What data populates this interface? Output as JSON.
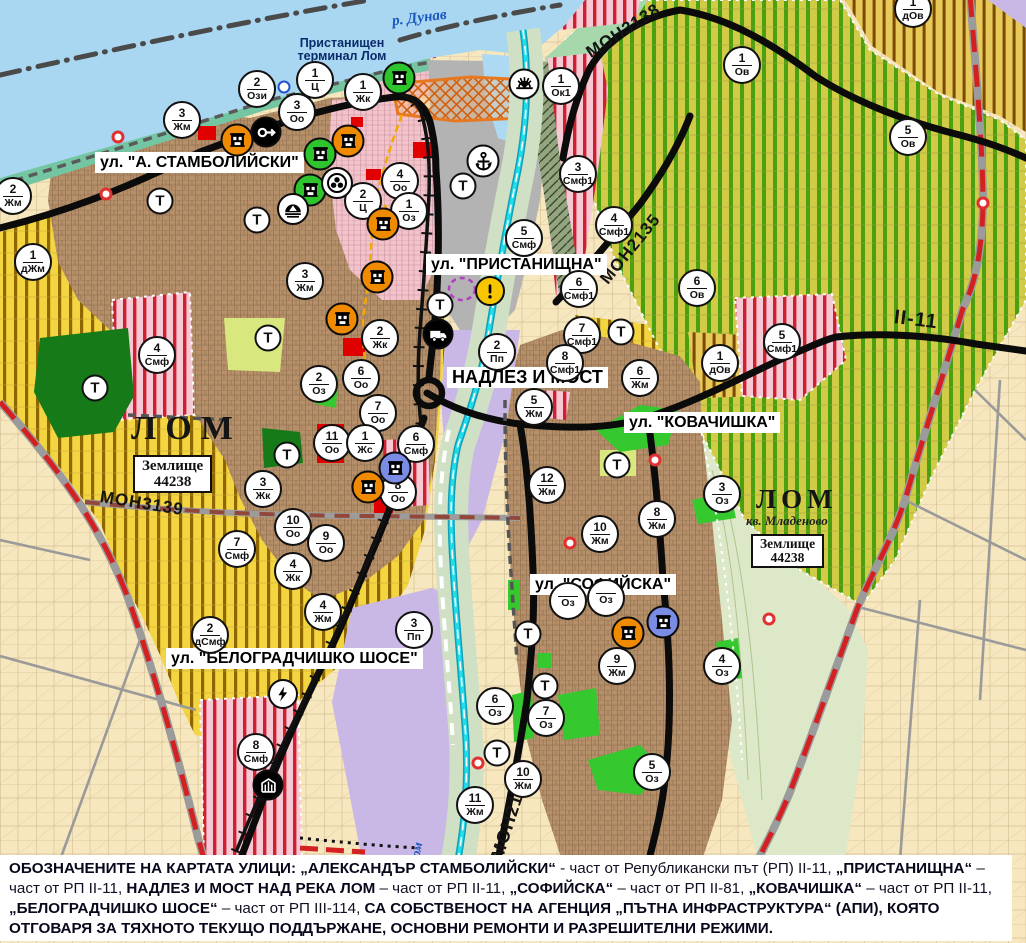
{
  "map": {
    "place_labels": {
      "danube": "р. Дунав",
      "terminal_line1": "Пристанищен",
      "terminal_line2": "терминал Лом",
      "lom_city": "ЛОМ",
      "zemlishte1_line1": "Землище",
      "zemlishte1_line2": "44238",
      "lom_mladenovo": "ЛОМ",
      "kv_mladenovo": "кв. Младеново",
      "zemlishte2_line1": "Землище",
      "zemlishte2_line2": "44238"
    },
    "road_labels": {
      "mon3139": "МОН3139",
      "mon3138": "МОН3138",
      "mon2135": "МОН2135",
      "mon2136": "МОН2136",
      "ii11": "II-11",
      "lom_river": "Лом"
    },
    "street_labels": [
      {
        "id": "stamb",
        "text": "ул. \"А. СТАМБОЛИЙСКИ\"",
        "x": 95,
        "y": 152
      },
      {
        "id": "prist",
        "text": "ул. \"ПРИСТАНИЩНА\"",
        "x": 426,
        "y": 254
      },
      {
        "id": "nadlez",
        "text": "НАДЛЕЗ И МОСТ",
        "x": 447,
        "y": 367,
        "big": true
      },
      {
        "id": "kovach",
        "text": "ул. \"КОВАЧИШКА\"",
        "x": 624,
        "y": 412
      },
      {
        "id": "sofia",
        "text": "ул. \"СОФИЙСКА\"",
        "x": 530,
        "y": 574
      },
      {
        "id": "belograd",
        "text": "ул. \"БЕЛОГРАДЧИШКО ШОСЕ\"",
        "x": 166,
        "y": 648
      }
    ],
    "zone_markers": [
      {
        "x": 257,
        "y": 89,
        "num": "2",
        "code": "Ози"
      },
      {
        "x": 315,
        "y": 80,
        "num": "1",
        "code": "Ц"
      },
      {
        "x": 363,
        "y": 92,
        "num": "1",
        "code": "Жк"
      },
      {
        "x": 297,
        "y": 112,
        "num": "3",
        "code": "Оо"
      },
      {
        "x": 182,
        "y": 120,
        "num": "3",
        "code": "Жм"
      },
      {
        "x": 13,
        "y": 196,
        "num": "2",
        "code": "Жм"
      },
      {
        "x": 33,
        "y": 262,
        "num": "1",
        "code": "дЖм"
      },
      {
        "x": 400,
        "y": 181,
        "num": "4",
        "code": "Оо"
      },
      {
        "x": 363,
        "y": 201,
        "num": "2",
        "code": "Ц"
      },
      {
        "x": 409,
        "y": 211,
        "num": "1",
        "code": "Оз"
      },
      {
        "x": 305,
        "y": 281,
        "num": "3",
        "code": "Жм"
      },
      {
        "x": 561,
        "y": 86,
        "num": "1",
        "code": "Ок1"
      },
      {
        "x": 742,
        "y": 65,
        "num": "1",
        "code": "Ов"
      },
      {
        "x": 908,
        "y": 137,
        "num": "5",
        "code": "Ов"
      },
      {
        "x": 913,
        "y": 9,
        "num": "1",
        "code": "дОв"
      },
      {
        "x": 578,
        "y": 174,
        "num": "3",
        "code": "Смф1"
      },
      {
        "x": 614,
        "y": 225,
        "num": "4",
        "code": "Смф1"
      },
      {
        "x": 524,
        "y": 238,
        "num": "5",
        "code": "Смф"
      },
      {
        "x": 579,
        "y": 289,
        "num": "6",
        "code": "Смф1"
      },
      {
        "x": 582,
        "y": 335,
        "num": "7",
        "code": "Смф1"
      },
      {
        "x": 565,
        "y": 363,
        "num": "8",
        "code": "Смф1"
      },
      {
        "x": 697,
        "y": 288,
        "num": "6",
        "code": "Ов"
      },
      {
        "x": 720,
        "y": 363,
        "num": "1",
        "code": "дОв"
      },
      {
        "x": 782,
        "y": 342,
        "num": "5",
        "code": "Смф1"
      },
      {
        "x": 497,
        "y": 352,
        "num": "2",
        "code": "Пп"
      },
      {
        "x": 157,
        "y": 355,
        "num": "4",
        "code": "Смф"
      },
      {
        "x": 319,
        "y": 384,
        "num": "2",
        "code": "Оз"
      },
      {
        "x": 361,
        "y": 378,
        "num": "6",
        "code": "Оо"
      },
      {
        "x": 380,
        "y": 338,
        "num": "2",
        "code": "Жк"
      },
      {
        "x": 378,
        "y": 413,
        "num": "7",
        "code": "Оо"
      },
      {
        "x": 332,
        "y": 443,
        "num": "11",
        "code": "Оо"
      },
      {
        "x": 365,
        "y": 443,
        "num": "1",
        "code": "Жс"
      },
      {
        "x": 416,
        "y": 444,
        "num": "6",
        "code": "Смф"
      },
      {
        "x": 398,
        "y": 492,
        "num": "8",
        "code": "Оо"
      },
      {
        "x": 263,
        "y": 489,
        "num": "3",
        "code": "Жк"
      },
      {
        "x": 293,
        "y": 527,
        "num": "10",
        "code": "Оо"
      },
      {
        "x": 326,
        "y": 543,
        "num": "9",
        "code": "Оо"
      },
      {
        "x": 293,
        "y": 571,
        "num": "4",
        "code": "Жк"
      },
      {
        "x": 237,
        "y": 549,
        "num": "7",
        "code": "Смф"
      },
      {
        "x": 534,
        "y": 407,
        "num": "5",
        "code": "Жм"
      },
      {
        "x": 640,
        "y": 378,
        "num": "6",
        "code": "Жм"
      },
      {
        "x": 547,
        "y": 485,
        "num": "12",
        "code": "Жм"
      },
      {
        "x": 600,
        "y": 534,
        "num": "10",
        "code": "Жм"
      },
      {
        "x": 657,
        "y": 519,
        "num": "8",
        "code": "Жм"
      },
      {
        "x": 722,
        "y": 494,
        "num": "3",
        "code": "Оз"
      },
      {
        "x": 568,
        "y": 601,
        "num": "",
        "code": "Оз"
      },
      {
        "x": 606,
        "y": 598,
        "num": "",
        "code": "Оз"
      },
      {
        "x": 617,
        "y": 666,
        "num": "9",
        "code": "Жм"
      },
      {
        "x": 722,
        "y": 666,
        "num": "4",
        "code": "Оз"
      },
      {
        "x": 546,
        "y": 718,
        "num": "7",
        "code": "Оз"
      },
      {
        "x": 495,
        "y": 706,
        "num": "6",
        "code": "Оз"
      },
      {
        "x": 652,
        "y": 772,
        "num": "5",
        "code": "Оз"
      },
      {
        "x": 523,
        "y": 779,
        "num": "10",
        "code": "Жм"
      },
      {
        "x": 475,
        "y": 805,
        "num": "11",
        "code": "Жм"
      },
      {
        "x": 210,
        "y": 635,
        "num": "2",
        "code": "дСмф"
      },
      {
        "x": 323,
        "y": 612,
        "num": "4",
        "code": "Жм"
      },
      {
        "x": 414,
        "y": 630,
        "num": "3",
        "code": "Пп"
      },
      {
        "x": 256,
        "y": 752,
        "num": "8",
        "code": "Смф"
      }
    ],
    "t_markers": [
      {
        "x": 160,
        "y": 201
      },
      {
        "x": 257,
        "y": 220
      },
      {
        "x": 463,
        "y": 186
      },
      {
        "x": 440,
        "y": 305
      },
      {
        "x": 268,
        "y": 338
      },
      {
        "x": 95,
        "y": 388
      },
      {
        "x": 287,
        "y": 455
      },
      {
        "x": 621,
        "y": 332
      },
      {
        "x": 617,
        "y": 465
      },
      {
        "x": 528,
        "y": 634
      },
      {
        "x": 545,
        "y": 686
      },
      {
        "x": 497,
        "y": 753
      }
    ],
    "icon_markers": [
      {
        "x": 237,
        "y": 140,
        "type": "monument",
        "color": "orange"
      },
      {
        "x": 348,
        "y": 141,
        "type": "monument",
        "color": "orange"
      },
      {
        "x": 383,
        "y": 224,
        "type": "monument",
        "color": "orange"
      },
      {
        "x": 377,
        "y": 277,
        "type": "monument",
        "color": "orange"
      },
      {
        "x": 342,
        "y": 319,
        "type": "monument",
        "color": "orange"
      },
      {
        "x": 368,
        "y": 487,
        "type": "monument",
        "color": "orange"
      },
      {
        "x": 628,
        "y": 633,
        "type": "monument",
        "color": "orange"
      },
      {
        "x": 399,
        "y": 78,
        "type": "monument",
        "color": "green"
      },
      {
        "x": 320,
        "y": 154,
        "type": "monument",
        "color": "green"
      },
      {
        "x": 310,
        "y": 190,
        "type": "monument",
        "color": "green"
      },
      {
        "x": 395,
        "y": 468,
        "type": "monument",
        "color": "blue"
      },
      {
        "x": 663,
        "y": 622,
        "type": "monument",
        "color": "blue"
      },
      {
        "x": 266,
        "y": 132,
        "type": "key"
      },
      {
        "x": 337,
        "y": 183,
        "type": "rotunda"
      },
      {
        "x": 293,
        "y": 209,
        "type": "tunnel"
      },
      {
        "x": 483,
        "y": 161,
        "type": "anchor"
      },
      {
        "x": 524,
        "y": 84,
        "type": "sun"
      },
      {
        "x": 490,
        "y": 291,
        "type": "warning"
      },
      {
        "x": 438,
        "y": 334,
        "type": "truck"
      },
      {
        "x": 283,
        "y": 694,
        "type": "lightning"
      },
      {
        "x": 268,
        "y": 785,
        "type": "rail-crossing"
      },
      {
        "x": 284,
        "y": 87,
        "type": "ring"
      },
      {
        "x": 106,
        "y": 194,
        "type": "dot"
      },
      {
        "x": 118,
        "y": 137,
        "type": "dot"
      },
      {
        "x": 570,
        "y": 543,
        "type": "dot"
      },
      {
        "x": 655,
        "y": 460,
        "type": "dot"
      },
      {
        "x": 769,
        "y": 619,
        "type": "dot"
      },
      {
        "x": 478,
        "y": 763,
        "type": "dot"
      },
      {
        "x": 983,
        "y": 203,
        "type": "dot"
      }
    ],
    "footnote_segments": [
      {
        "t": "ОБОЗНАЧЕНИТЕ НА КАРТАТА УЛИЦИ: „АЛЕКСАНДЪР СТАМБОЛИЙСКИ“ ",
        "b": true
      },
      {
        "t": "- част от Републикански път (РП) II-11, ",
        "b": false
      },
      {
        "t": "„ПРИСТАНИЩНА“ ",
        "b": true
      },
      {
        "t": "– част от РП II-11, ",
        "b": false
      },
      {
        "t": "НАДЛЕЗ И МОСТ НАД РЕКА ЛОМ ",
        "b": true
      },
      {
        "t": "– част от РП II-11, ",
        "b": false
      },
      {
        "t": "„СОФИЙСКА“ ",
        "b": true
      },
      {
        "t": "– част от РП II-81, ",
        "b": false
      },
      {
        "t": "„КОВАЧИШКА“ ",
        "b": true
      },
      {
        "t": "– част от РП II-11, ",
        "b": false
      },
      {
        "t": "„БЕЛОГРАДЧИШКО ШОСЕ“ ",
        "b": true
      },
      {
        "t": "– част от РП III-114, ",
        "b": false
      },
      {
        "t": "СА СОБСТВЕНОСТ НА АГЕНЦИЯ „ПЪТНА ИНФРАСТРУКТУРА“ (АПИ), КОЯТО ОТГОВАРЯ ЗА ТЯХНОТО ТЕКУЩО ПОДДЪРЖАНЕ, ОСНОВНИ РЕМОНТИ И РАЗРЕШИТЕЛНИ РЕЖИМИ.",
        "b": true
      }
    ],
    "colors": {
      "water": "#A9D7F2",
      "river_cyan": "#1FDDEB",
      "urban": "#B5906A",
      "purple_zone": "#C9B7E6",
      "port_gray": "#B3B3B3",
      "yellow_zone": "#F3D541",
      "green_zone_stripe": "#4BA011",
      "smf_stripe": "#D02030",
      "monument_orange": "#F08A00",
      "monument_green": "#2DC42D",
      "monument_blue": "#7B8CE4",
      "road_red_dash": "#D32121",
      "bright_green": "#35C92F"
    }
  }
}
